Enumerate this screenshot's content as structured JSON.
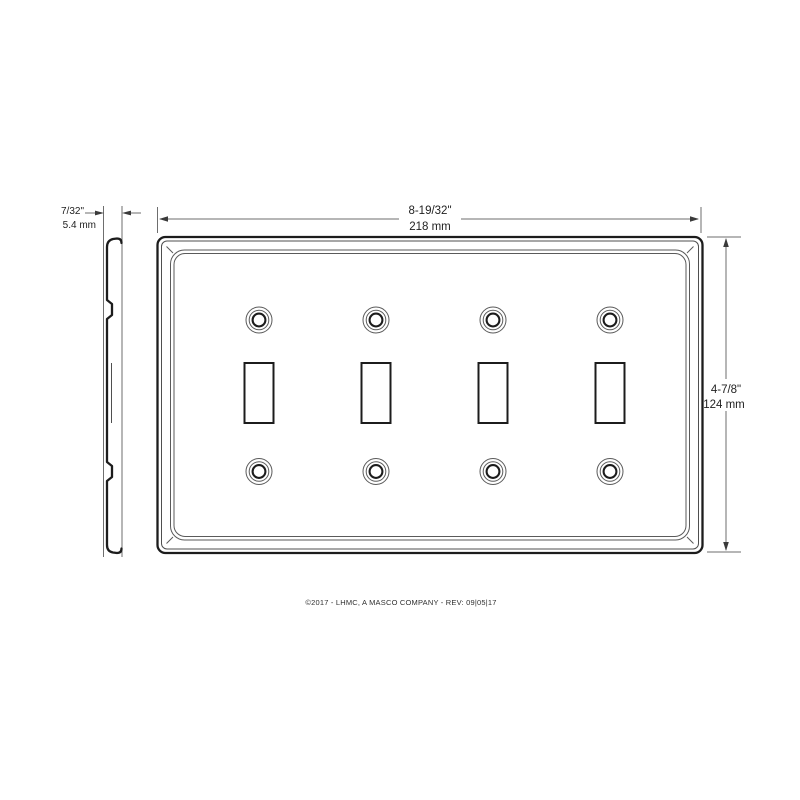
{
  "drawing": {
    "footer": "©2017 - LHMC, A MASCO COMPANY - REV: 09|05|17",
    "gang_count": 4,
    "colors": {
      "outline": "#1c1c1c",
      "thin_line": "#4f4f4f",
      "dimension_line": "#6e6e6e",
      "text": "#1f1f1f",
      "background": "#ffffff"
    },
    "dimensions": {
      "thickness": {
        "imperial": "7/32\"",
        "metric": "5.4 mm"
      },
      "width": {
        "imperial": "8-19/32\"",
        "metric": "218 mm"
      },
      "height": {
        "imperial": "4-7/8\"",
        "metric": "124 mm"
      }
    }
  }
}
